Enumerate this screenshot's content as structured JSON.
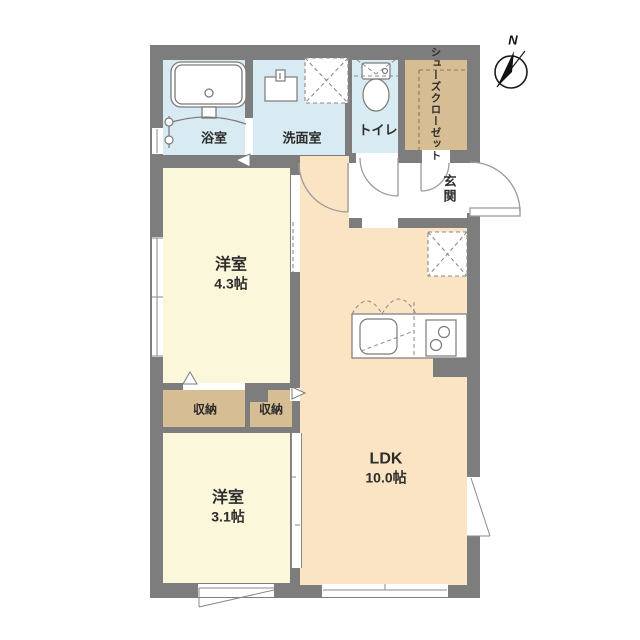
{
  "plan": {
    "title": "floor-plan",
    "compass": {
      "north_label": "N"
    },
    "rooms": {
      "bath": "浴室",
      "washroom": "洗面室",
      "toilet": "トイレ",
      "shoes_closet_line1": "シューズ",
      "shoes_closet_line2": "クローゼット",
      "entrance": "玄関",
      "western_room_1_name": "洋室",
      "western_room_1_size": "4.3帖",
      "storage_left": "収納",
      "storage_right": "収納",
      "western_room_2_name": "洋室",
      "western_room_2_size": "3.1帖",
      "ldk_name": "LDK",
      "ldk_size": "10.0帖"
    },
    "colors": {
      "wall": "#7d7d7d",
      "wet": "#d8eaf2",
      "room": "#fbf7da",
      "ldk": "#fae4c3",
      "closet": "#d6bd93",
      "line": "#808080"
    }
  }
}
